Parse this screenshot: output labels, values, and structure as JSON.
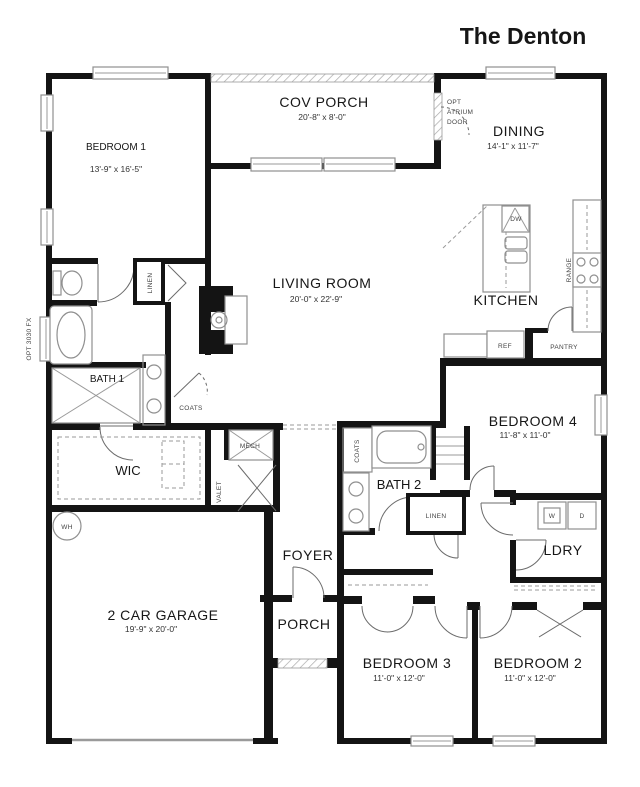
{
  "title": "The Denton",
  "rooms": {
    "bedroom1": {
      "name": "BEDROOM 1",
      "dims": "13'-9\" x 16'-5\""
    },
    "cov_porch": {
      "name": "COV PORCH",
      "dims": "20'-8\" x 8'-0\""
    },
    "dining": {
      "name": "DINING",
      "dims": "14'-1\" x 11'-7\""
    },
    "living_room": {
      "name": "LIVING ROOM",
      "dims": "20'-0\" x 22'-9\""
    },
    "kitchen": {
      "name": "KITCHEN"
    },
    "bath1": {
      "name": "BATH 1"
    },
    "wic": {
      "name": "WIC"
    },
    "bedroom4": {
      "name": "BEDROOM 4",
      "dims": "11'-8\" x 11'-0\""
    },
    "bath2": {
      "name": "BATH 2"
    },
    "laundry": {
      "name": "LDRY"
    },
    "garage": {
      "name": "2 CAR GARAGE",
      "dims": "19'-9\" x 20'-0\""
    },
    "foyer": {
      "name": "FOYER"
    },
    "porch": {
      "name": "PORCH"
    },
    "bedroom3": {
      "name": "BEDROOM 3",
      "dims": "11'-0\" x 12'-0\""
    },
    "bedroom2": {
      "name": "BEDROOM 2",
      "dims": "11'-0\" x 12'-0\""
    }
  },
  "labels": {
    "atrium_lines": [
      "OPT",
      "ATRIUM",
      "DOOR"
    ],
    "opt_window": "OPT 3030 FX",
    "linen_bath1": "LINEN",
    "coats_hall": "COATS",
    "mech": "MECH",
    "valet": "VALET",
    "water_heater": "WH",
    "dishwasher": "DW",
    "range": "RANGE",
    "fridge": "REF",
    "pantry": "PANTRY",
    "coats_bath2": "COATS",
    "linen_hall": "LINEN",
    "washer": "W",
    "dryer": "D"
  },
  "colors": {
    "wall": "#141414",
    "fixture": "#8f8f8f",
    "text": "#161616"
  }
}
